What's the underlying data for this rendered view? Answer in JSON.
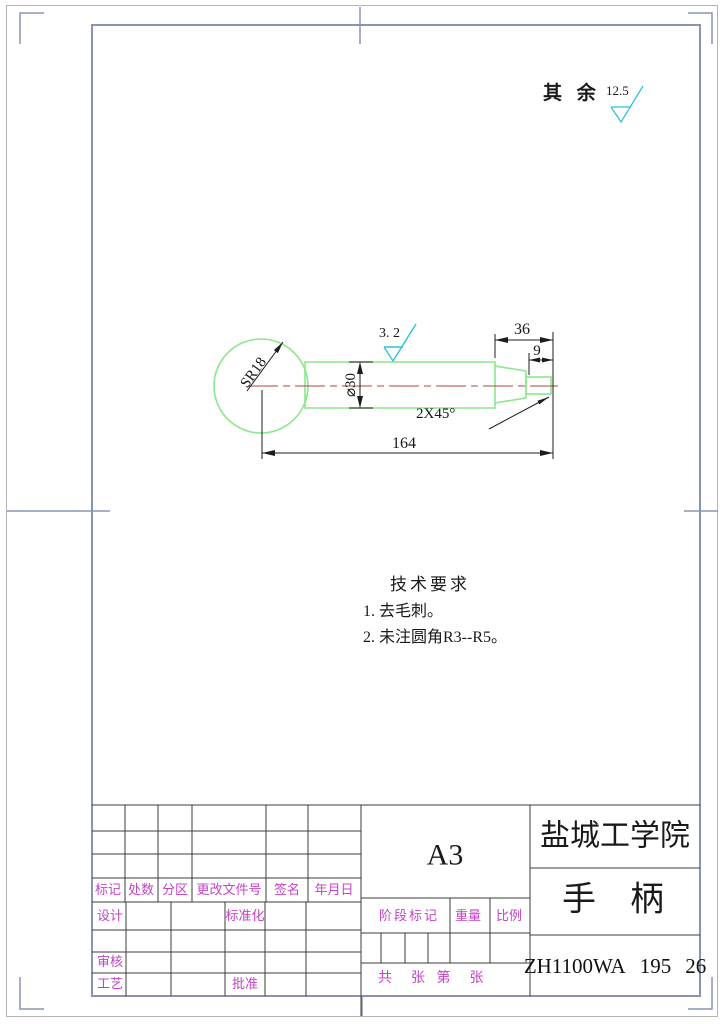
{
  "sheet": {
    "other_surfaces_label": "其 余",
    "other_surfaces_value": "12.5"
  },
  "colors": {
    "outline_green": "#8ce68c",
    "centerline_red": "#b04545",
    "cyan_symbol": "#2fc4d6",
    "magenta_text": "#c444c8",
    "frame_gray_blue": "#8a93b5"
  },
  "drawing": {
    "dims": {
      "overall_length": "164",
      "len36": "36",
      "len9": "9",
      "chamfer": "2X45°",
      "diameter": "⌀30",
      "sphere_radius": "SR18",
      "roughness": "3. 2"
    }
  },
  "tech_req": {
    "title": "技术要求",
    "items": [
      "1. 去毛刺。",
      "2. 未注圆角R3--R5。"
    ]
  },
  "title_block": {
    "paper_size": "A3",
    "school": "盐城工学院",
    "part_name": "手　柄",
    "code": "ZH1100WA",
    "num1": "195",
    "num2": "26",
    "headers": {
      "mark": "标记",
      "count": "处数",
      "zone": "分区",
      "change_file": "更改文件号",
      "signature": "签名",
      "date": "年月日"
    },
    "roles": {
      "design": "设计",
      "standardization": "标准化",
      "review": "审核",
      "process": "工艺",
      "approve": "批准"
    },
    "stage": {
      "stage_mark": "阶段标记",
      "weight": "重量",
      "scale": "比例"
    },
    "sheets": "共  张 第  张"
  }
}
